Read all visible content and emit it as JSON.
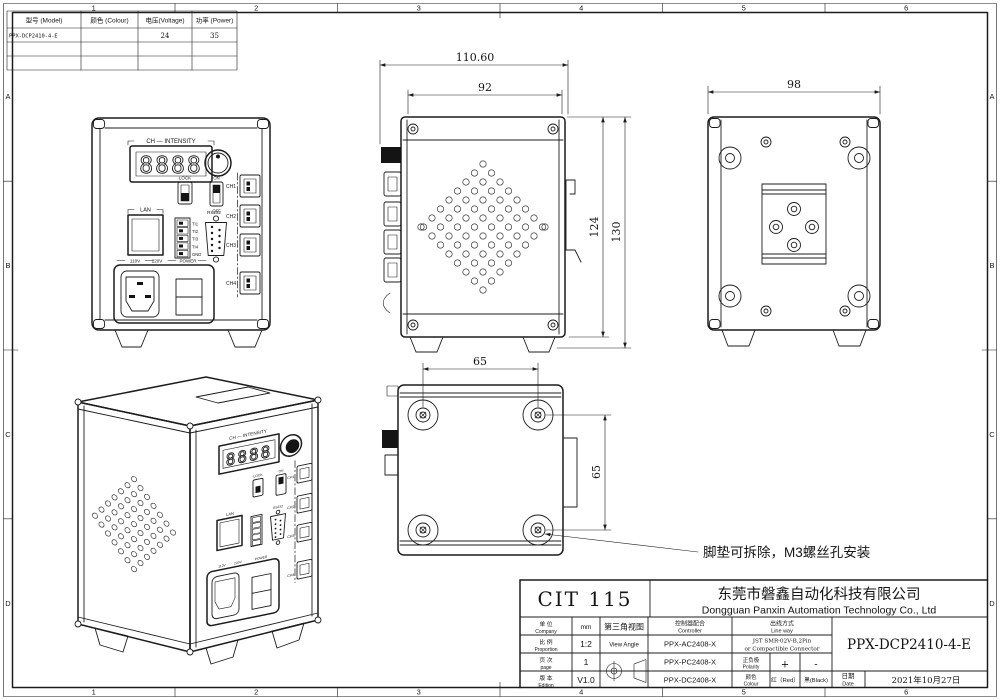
{
  "sheet": {
    "zones_top": [
      "1",
      "2",
      "3",
      "4",
      "5",
      "6"
    ],
    "zones_bottom": [
      "1",
      "2",
      "3",
      "4",
      "5",
      "6"
    ],
    "zones_left": [
      "A",
      "B",
      "C",
      "D"
    ],
    "zones_right": [
      "A",
      "B",
      "C",
      "D"
    ]
  },
  "spec_table": {
    "headers": {
      "model": "型号  (Model)",
      "colour": "颜色  (Colour)",
      "voltage": "电压(Voltage)",
      "power": "功率 (Power)"
    },
    "row": {
      "model": "PPX-DCP2410-4-E",
      "colour": "",
      "voltage": "24",
      "power": "35"
    }
  },
  "front_view": {
    "labels": {
      "display_title": "CH — INTENSITY",
      "digits": "8888",
      "lock": "LOCK",
      "on": "ON",
      "off": "OFF",
      "lan": "LAN",
      "rs232": "RS232",
      "terminals": [
        "TI1",
        "TI2",
        "TI3",
        "TI4",
        "GND"
      ],
      "channels": [
        "CH1",
        "CH2",
        "CH3",
        "CH4"
      ],
      "v110": "110V",
      "v220": "220V",
      "power": "POWER"
    }
  },
  "dimensions": {
    "overall_width": "110.60",
    "body_width": "92",
    "rear_width": "98",
    "height_inner": "124",
    "height_overall": "130",
    "foot_spacing_x": "65",
    "foot_spacing_y": "65"
  },
  "annotation": {
    "feet_note": "脚垫可拆除，M3螺丝孔安装"
  },
  "title_block": {
    "code": "CIT 115",
    "company_cn": "东莞市磐鑫自动化科技有限公司",
    "company_en": "Dongguan Panxin Automation Technology Co., Ltd",
    "fields": {
      "unit_cn": "单 位",
      "unit_en": "Company",
      "unit_val": "mm",
      "scale_cn": "比 例",
      "scale_en": "Proportion",
      "scale_val": "1:2",
      "page_cn": "页 次",
      "page_en": "page",
      "page_val": "1",
      "edition_cn": "版 本",
      "edition_en": "Edition",
      "edition_val": "V1.0"
    },
    "view_angle_cn": "第三角视图",
    "view_angle_en": "View Angle",
    "controller_cn": "控制器配合",
    "controller_en": "Controller",
    "controllers": [
      "PPX-AC2408-X",
      "PPX-PC2408-X",
      "PPX-DC2408-X"
    ],
    "lineway_cn": "出线方式",
    "lineway_en": "Line way",
    "lineway_val1": "JST SMR-02V-B,2Pin",
    "lineway_val2": "or Compactible Connector",
    "polarity_cn": "正负极",
    "polarity_en": "Polarity",
    "polarity_plus": "+",
    "polarity_minus": "-",
    "colour_cn": "颜色",
    "colour_en": "Colour",
    "colour_red": "红（Red）",
    "colour_black": "黑(Black)",
    "part_no": "PPX-DCP2410-4-E",
    "date_cn": "日期",
    "date_en": "Date",
    "date_val": "2021年10月27日"
  }
}
